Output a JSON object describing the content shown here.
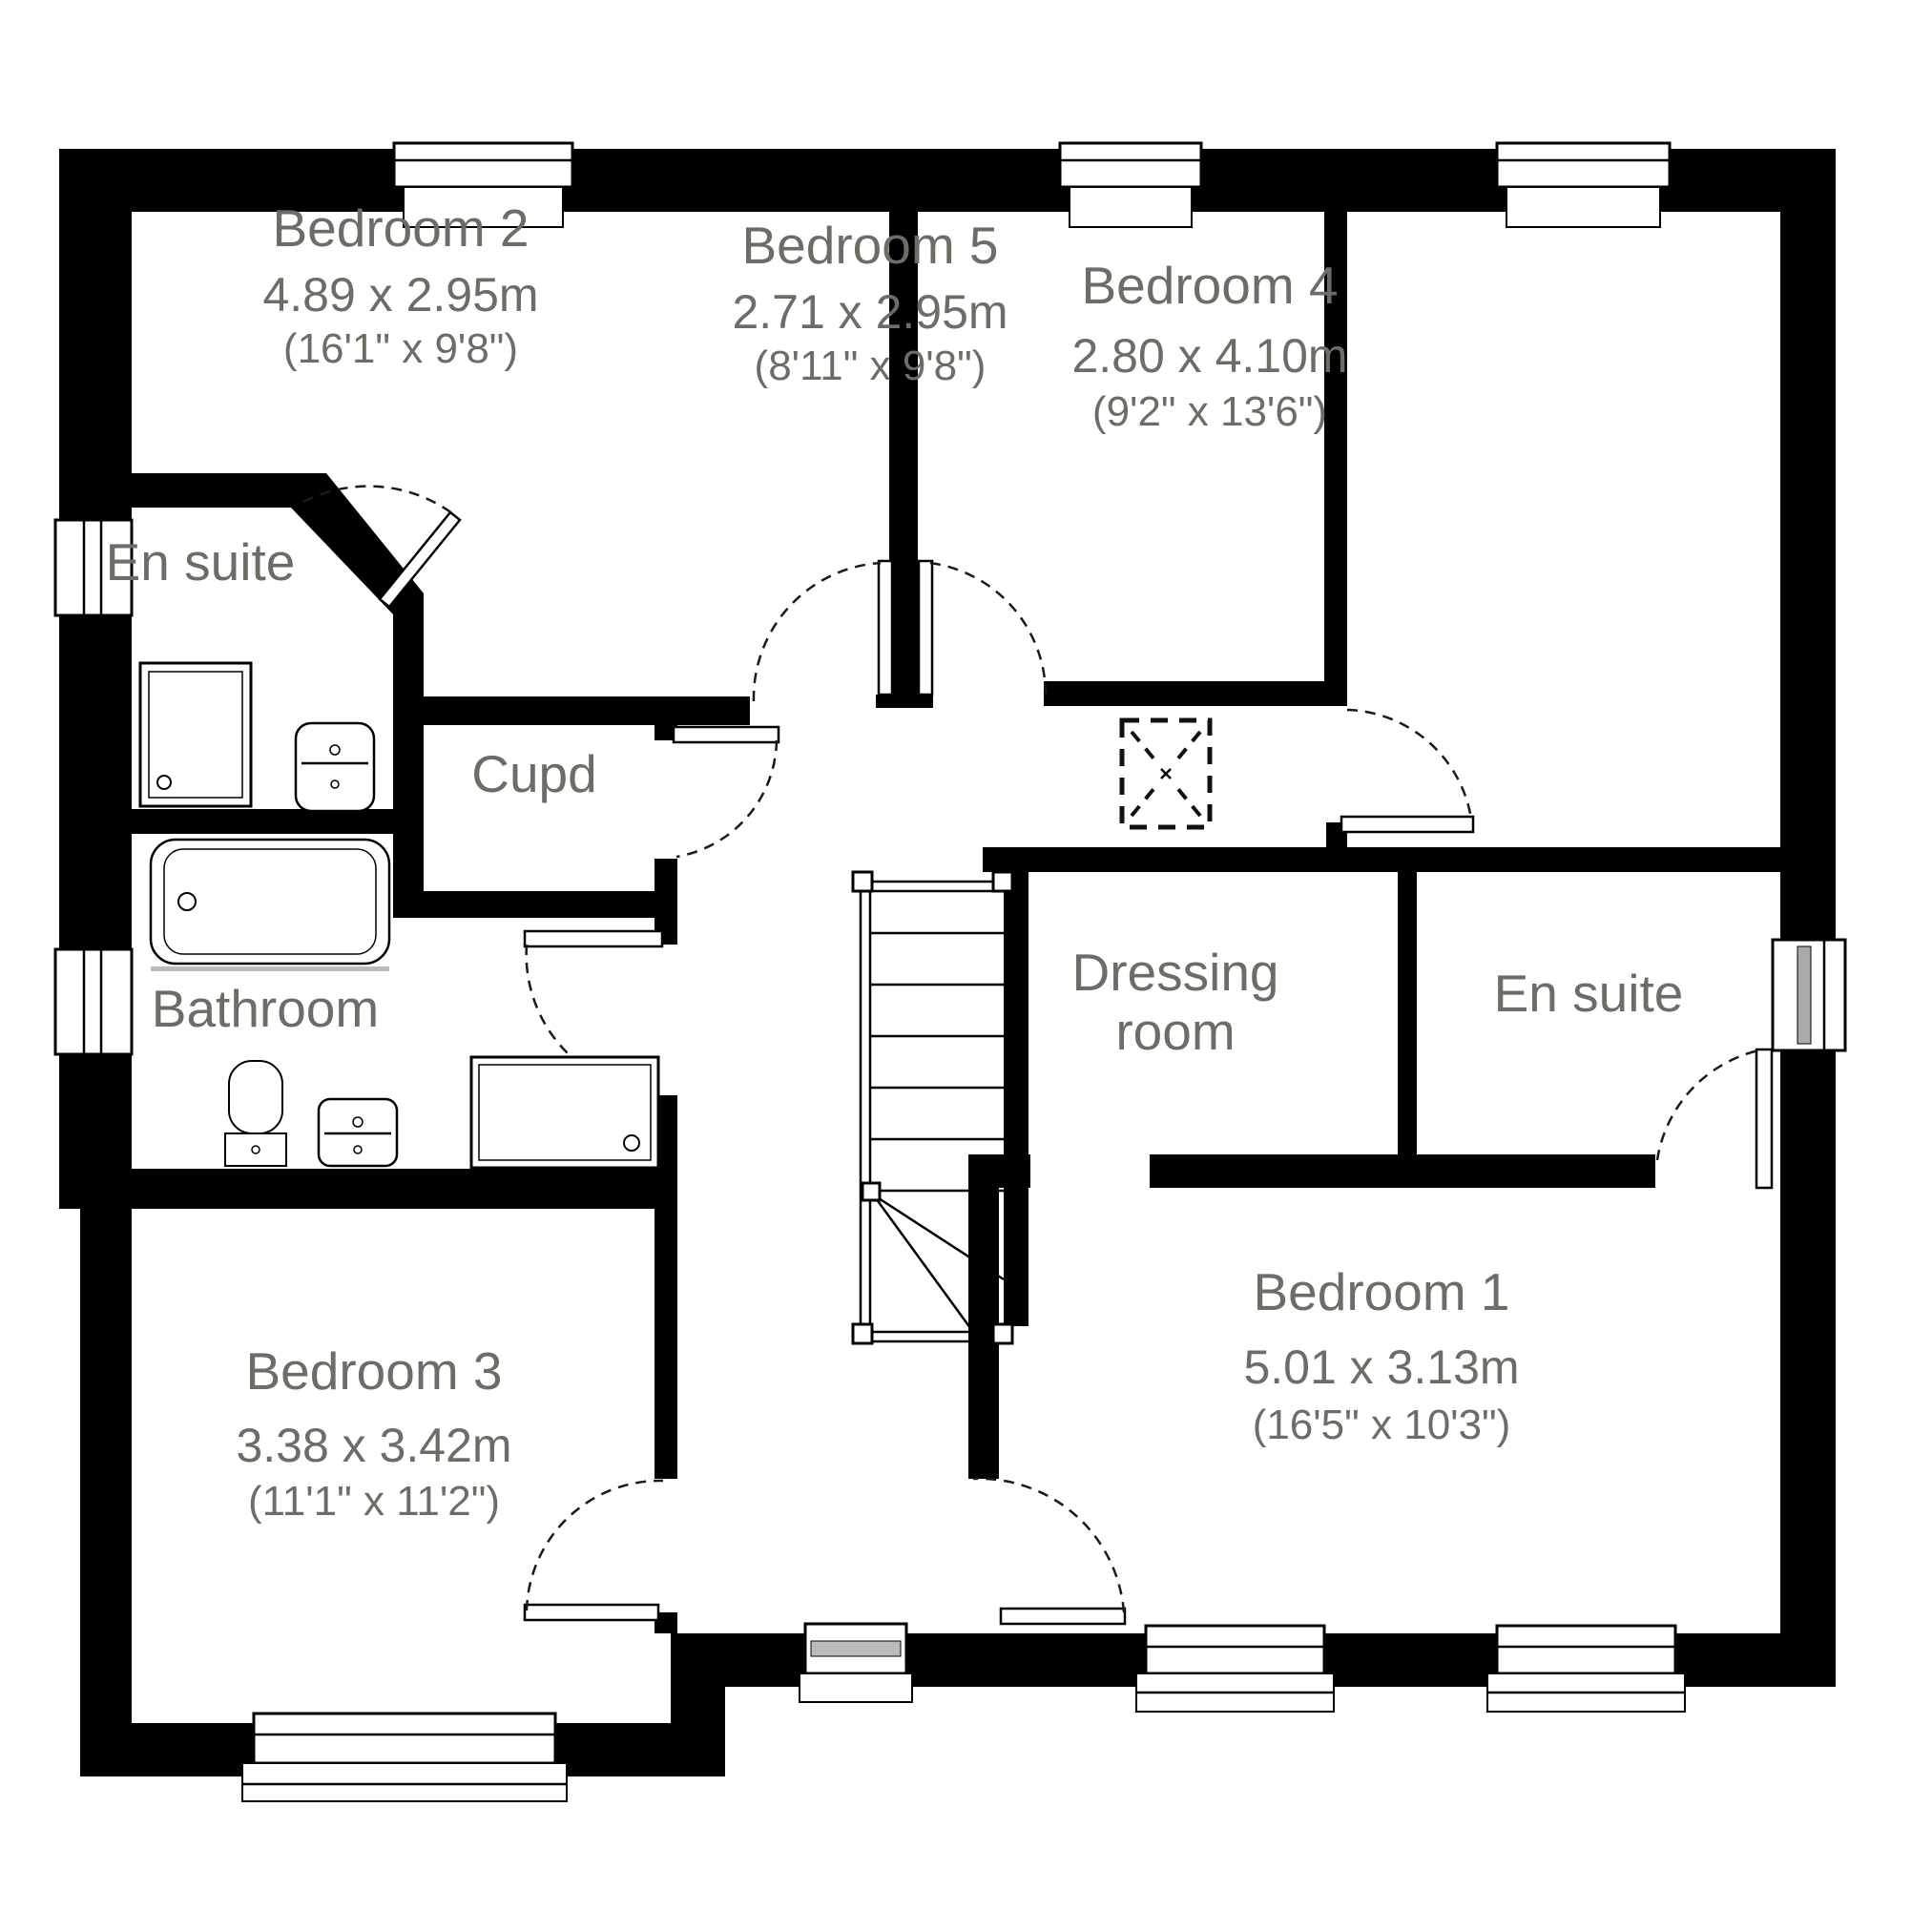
{
  "diagram": {
    "type": "floor-plan",
    "colors": {
      "background": "#ffffff",
      "walls": "#000000",
      "labels": "#6a6f66"
    }
  },
  "rooms": [
    {
      "id": "bedroom-2",
      "name": "Bedroom 2",
      "dim_metric": "4.89 x 2.95m",
      "dim_imperial": "(16'1\" x 9'8\")"
    },
    {
      "id": "bedroom-5",
      "name": "Bedroom 5",
      "dim_metric": "2.71 x 2.95m",
      "dim_imperial": "(8'11\" x 9'8\")"
    },
    {
      "id": "bedroom-4",
      "name": "Bedroom 4",
      "dim_metric": "2.80 x 4.10m",
      "dim_imperial": "(9'2\" x 13'6\")"
    },
    {
      "id": "en-suite-left",
      "name": "En suite"
    },
    {
      "id": "cupboard",
      "name": "Cupd"
    },
    {
      "id": "bathroom",
      "name": "Bathroom"
    },
    {
      "id": "dressing-room",
      "name_line1": "Dressing",
      "name_line2": "room"
    },
    {
      "id": "en-suite-right",
      "name": "En suite"
    },
    {
      "id": "bedroom-3",
      "name": "Bedroom 3",
      "dim_metric": "3.38 x 3.42m",
      "dim_imperial": "(11'1\" x 11'2\")"
    },
    {
      "id": "bedroom-1",
      "name": "Bedroom 1",
      "dim_metric": "5.01 x 3.13m",
      "dim_imperial": "(16'5\" x 10'3\")"
    }
  ]
}
